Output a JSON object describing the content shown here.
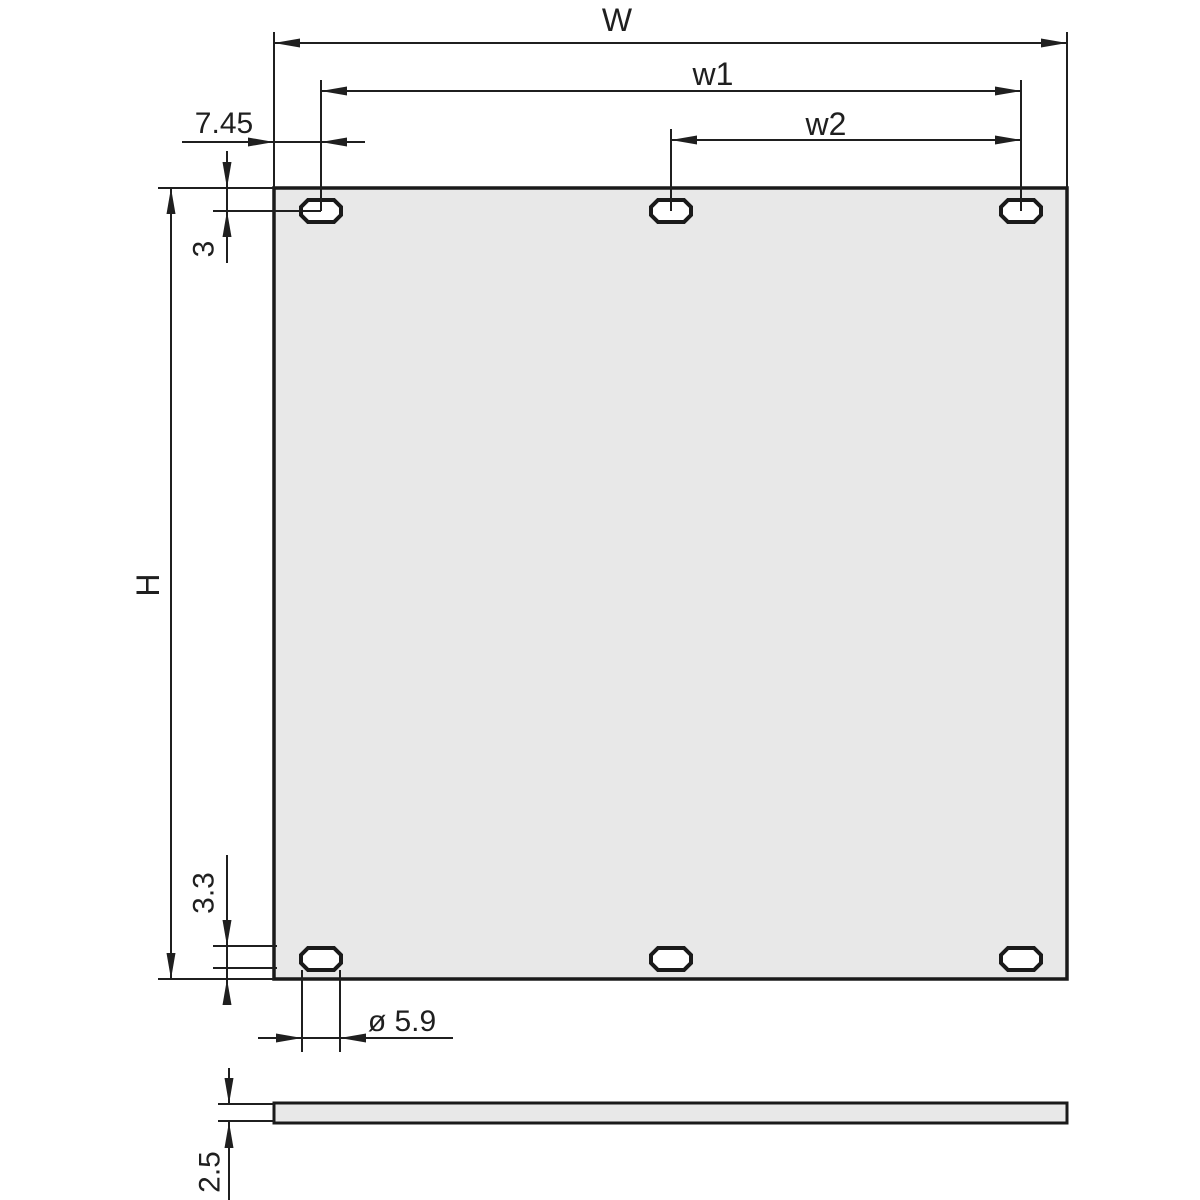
{
  "drawing": {
    "type": "engineering-dimension-drawing",
    "subject": "rack front panel with six oval mounting slots, front view and side section view",
    "labels": {
      "overall_width": "W",
      "hole_span_w1": "w1",
      "hole_span_w2": "w2",
      "side_offset": "7.45",
      "top_hole_offset": "3",
      "overall_height": "H",
      "bottom_hole_offset": "3.3",
      "hole_diameter": "ø 5.9",
      "panel_thickness": "2.5"
    }
  },
  "colors": {
    "line": "#1f1f1f",
    "panel_fill": "#e8e8e8",
    "hole_fill": "#ffffff",
    "background": "#ffffff"
  }
}
